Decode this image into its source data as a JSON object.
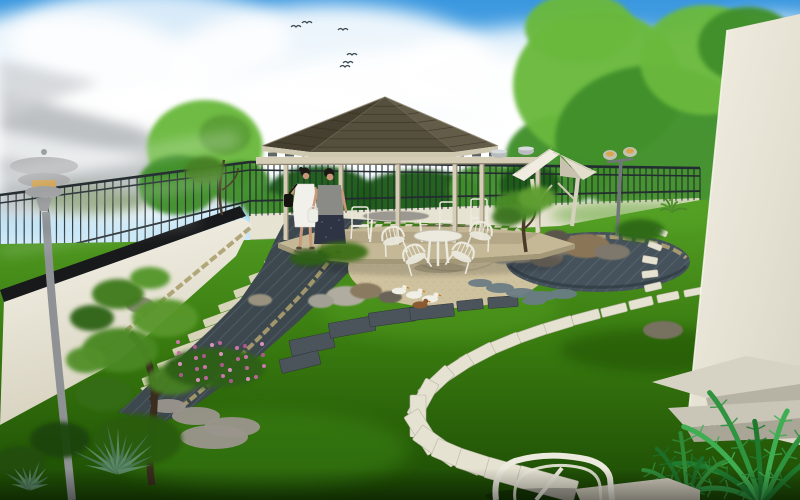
{
  "scene_type": "3d-garden-landscape-render",
  "palette": {
    "skyTop": "#3a97df",
    "skyLow": "#cfeaf8",
    "cloud": "#ffffff",
    "bird": "#3a4a55",
    "treeLight": "#6ab93c",
    "treeMid": "#3f8f2a",
    "treeDark": "#1f5c16",
    "fence": "#232c30",
    "backWall": "#e7e3d3",
    "coping": "#17191b",
    "roofLeft": "#45402f",
    "roofFront": "#554f3e",
    "roofRight": "#635c48",
    "fascia": "#cfc8b0",
    "wood": "#d5cdb5",
    "woodShade": "#9a9178",
    "floorTan": "#c4b896",
    "floorEdge": "#a39878",
    "gravel": "#cfc29e",
    "gravelEdge": "#8f8468",
    "pathDark": "#3d484e",
    "paverCream": "#ded8c2",
    "curb": "#ab9e6e",
    "stoneWhite": "#e5e2d2",
    "stoneWhiteEdge": "#b8b5a5",
    "slabDark": "#4a545a",
    "stoneBlue": "#6a7c84",
    "stoneGrey": "#9a958c",
    "skin": "#c89878",
    "hair": "#1c1814",
    "dressWhite": "#f2f0ea",
    "bagBlack": "#15130f",
    "topGrey": "#8a8a86",
    "skirtNavy": "#2e3444",
    "bagWhite": "#eeeee8",
    "furnitureWhite": "#eceade",
    "tableTop": "#9a9890",
    "duckWhite": "#f0efe6",
    "duckBrown": "#8a5a30",
    "beakOrange": "#c87820",
    "lampMetal": "#8e9294",
    "lampGlow": "#d8a64e",
    "agaveGreen": "#5e8a68",
    "agaveDark": "#497554",
    "trunkBrown": "#4a3a28",
    "steps1": "#d6d2c4",
    "steps2": "#b6b2a4",
    "steps3": "#c9c5b7",
    "steps4": "#a9a597"
  },
  "scene": {
    "clouds": [
      [
        120,
        150,
        180,
        70,
        0.95
      ],
      [
        60,
        90,
        150,
        80,
        0.9
      ],
      [
        330,
        60,
        160,
        55,
        0.9
      ],
      [
        430,
        110,
        200,
        60,
        0.95
      ],
      [
        560,
        75,
        170,
        50,
        0.85
      ],
      [
        680,
        120,
        180,
        55,
        0.9
      ],
      [
        770,
        60,
        120,
        45,
        0.8
      ],
      [
        240,
        130,
        160,
        50,
        0.95
      ],
      [
        520,
        160,
        200,
        45,
        0.9
      ],
      [
        700,
        180,
        160,
        40,
        0.85
      ],
      [
        150,
        40,
        140,
        50,
        0.8
      ]
    ],
    "birds": [
      [
        296,
        27
      ],
      [
        307,
        23
      ],
      [
        343,
        30
      ],
      [
        352,
        55
      ],
      [
        348,
        63
      ],
      [
        345,
        67
      ]
    ],
    "foliage_bg": [
      [
        205,
        148,
        58,
        48,
        "treeLight"
      ],
      [
        178,
        185,
        40,
        30,
        "treeMid"
      ],
      [
        240,
        183,
        30,
        22,
        "treeMid"
      ],
      [
        320,
        196,
        55,
        30,
        "treeDark"
      ],
      [
        420,
        198,
        65,
        28,
        "treeDark"
      ],
      [
        488,
        190,
        40,
        26,
        "treeMid"
      ],
      [
        560,
        160,
        55,
        45,
        "treeMid"
      ],
      [
        598,
        85,
        85,
        75,
        "treeLight"
      ],
      [
        655,
        140,
        100,
        75,
        "treeMid"
      ],
      [
        705,
        60,
        65,
        55,
        "treeLight"
      ],
      [
        580,
        28,
        55,
        35,
        "treeLight"
      ],
      [
        748,
        45,
        50,
        38,
        "treeMid"
      ],
      [
        530,
        185,
        30,
        20,
        "treeDark"
      ],
      [
        265,
        205,
        22,
        14,
        "treeMid"
      ]
    ],
    "fence": [
      {
        "x1": 0,
        "x2": 250,
        "t1": 195,
        "t2": 162,
        "b1": 288,
        "b2": 216,
        "sp": 8
      },
      {
        "x1": 250,
        "x2": 700,
        "t1": 162,
        "t2": 168,
        "b1": 216,
        "b2": 200,
        "sp": 6
      }
    ],
    "paver_stripes": {
      "from": [
        320,
        227
      ],
      "to": [
        152,
        388
      ],
      "count": 12,
      "w": 52,
      "h": 8,
      "rot": -20
    },
    "stones_white": [
      [
        694,
        292,
        20,
        7
      ],
      [
        668,
        297,
        22,
        8
      ],
      [
        641,
        303,
        24,
        9
      ],
      [
        614,
        310,
        26,
        9
      ],
      [
        586,
        317,
        28,
        10
      ],
      [
        558,
        325,
        30,
        11
      ],
      [
        530,
        334,
        32,
        11
      ],
      [
        503,
        344,
        34,
        12
      ],
      [
        477,
        356,
        36,
        13
      ],
      [
        455,
        369,
        37,
        13
      ],
      [
        436,
        383,
        38,
        14
      ],
      [
        423,
        399,
        40,
        15
      ],
      [
        418,
        416,
        42,
        16
      ],
      [
        423,
        432,
        45,
        17
      ],
      [
        437,
        446,
        48,
        18
      ],
      [
        458,
        457,
        51,
        19
      ],
      [
        484,
        466,
        54,
        20
      ],
      [
        514,
        475,
        57,
        21
      ],
      [
        547,
        484,
        60,
        22
      ]
    ],
    "stones_right": [
      [
        661,
        232,
        6,
        13
      ],
      [
        655,
        246,
        6,
        14
      ],
      [
        650,
        260,
        7,
        15
      ],
      [
        650,
        274,
        7,
        16
      ],
      [
        653,
        287,
        7,
        17
      ]
    ],
    "slabs_dark": [
      [
        312,
        344,
        44,
        16,
        -12
      ],
      [
        352,
        327,
        46,
        15,
        -10
      ],
      [
        392,
        317,
        46,
        14,
        -8
      ],
      [
        432,
        312,
        44,
        13,
        -6
      ],
      [
        300,
        362,
        40,
        14,
        -14
      ],
      [
        470,
        305,
        26,
        10,
        -6
      ],
      [
        503,
        302,
        30,
        11,
        -4
      ]
    ],
    "stones_round": [
      [
        500,
        288,
        14,
        5,
        "stoneBlue"
      ],
      [
        521,
        293,
        15,
        5,
        "stoneBlue"
      ],
      [
        542,
        296,
        15,
        5,
        "stoneBlue"
      ],
      [
        563,
        294,
        14,
        5,
        "stoneBlue"
      ],
      [
        480,
        283,
        12,
        4,
        "stoneBlue"
      ],
      [
        534,
        301,
        12,
        4,
        "stoneBlue"
      ],
      [
        196,
        416,
        24,
        9,
        "stoneGrey"
      ],
      [
        232,
        427,
        28,
        10,
        "stoneGrey"
      ],
      [
        168,
        406,
        18,
        7,
        "stoneGrey"
      ],
      [
        214,
        437,
        34,
        12,
        "stoneGrey"
      ]
    ],
    "rocks": [
      [
        346,
        296,
        20,
        10,
        "#b0aca0"
      ],
      [
        321,
        301,
        13,
        7,
        "#a2a096"
      ],
      [
        366,
        291,
        16,
        8,
        "#8a7a60"
      ],
      [
        390,
        297,
        12,
        6,
        "#6a6458"
      ],
      [
        520,
        252,
        22,
        11,
        "#8a8478"
      ],
      [
        546,
        258,
        17,
        9,
        "#6f695e"
      ],
      [
        503,
        257,
        13,
        7,
        "#9a948a"
      ],
      [
        562,
        247,
        15,
        8,
        "#7a746a"
      ],
      [
        586,
        246,
        24,
        12,
        "#8a7456"
      ],
      [
        556,
        237,
        13,
        7,
        "#5a544c"
      ],
      [
        612,
        252,
        18,
        8,
        "#7e786c"
      ],
      [
        140,
        305,
        14,
        8,
        "#8e8a7e"
      ],
      [
        260,
        300,
        12,
        6,
        "#98927f"
      ],
      [
        663,
        330,
        20,
        9,
        "#77715f"
      ]
    ],
    "foliage_fg": [
      [
        120,
        350,
        38,
        22,
        "#4a8824"
      ],
      [
        165,
        318,
        33,
        19,
        "#58962c"
      ],
      [
        104,
        394,
        28,
        17,
        "#356c16"
      ],
      [
        172,
        380,
        26,
        15,
        "#477f20"
      ],
      [
        138,
        440,
        44,
        26,
        "#2c5c10"
      ],
      [
        86,
        360,
        20,
        13,
        "#52902a"
      ],
      [
        118,
        294,
        26,
        15,
        "#3f7a1e"
      ],
      [
        92,
        318,
        22,
        13,
        "#2f6414"
      ],
      [
        150,
        278,
        20,
        11,
        "#54962c"
      ],
      [
        215,
        368,
        50,
        20,
        "#2f6012"
      ],
      [
        518,
        206,
        24,
        15,
        "#4a8a28"
      ],
      [
        537,
        198,
        19,
        12,
        "#5f9e32"
      ],
      [
        507,
        217,
        15,
        9,
        "#3c7520"
      ],
      [
        640,
        230,
        24,
        11,
        "#2f6a14"
      ],
      [
        60,
        440,
        30,
        18,
        "#1c4408"
      ],
      [
        20,
        462,
        26,
        16,
        "#224e0a"
      ],
      [
        342,
        252,
        26,
        10,
        "#3c7018"
      ],
      [
        310,
        258,
        20,
        8,
        "#2f6012"
      ],
      [
        225,
        135,
        26,
        20,
        "#5a9e36"
      ],
      [
        205,
        170,
        20,
        14,
        "#447f24"
      ]
    ],
    "flowers": {
      "x": 178,
      "y": 342,
      "dx": 13,
      "dy": 11,
      "count": 28,
      "colors": [
        "#d878b8",
        "#b85898",
        "#e898cc",
        "#c867a6"
      ]
    },
    "agaves": [
      {
        "x": 118,
        "y": 472,
        "n": 13,
        "len": 52
      },
      {
        "x": 30,
        "y": 488,
        "n": 9,
        "len": 30
      }
    ],
    "palms": [
      {
        "x": 762,
        "y": 505,
        "n": 8,
        "a0": -175,
        "a1": -35,
        "len": 120,
        "arc": 26,
        "w": 5,
        "cols": [
          "#2f9440",
          "#1f7a2e",
          "#3fae52"
        ]
      },
      {
        "x": 688,
        "y": 505,
        "n": 6,
        "a0": -165,
        "a1": -50,
        "len": 70,
        "arc": 16,
        "w": 4,
        "cols": [
          "#1d6e28",
          "#2f8a38"
        ]
      },
      {
        "x": 672,
        "y": 212,
        "n": 7,
        "a0": -170,
        "a1": -10,
        "len": 16,
        "arc": 4,
        "w": 2,
        "cols": [
          "#4a8a2a",
          "#57982f"
        ]
      }
    ],
    "ducks": [
      [
        399,
        291,
        0.9,
        "duckWhite"
      ],
      [
        414,
        295,
        1,
        "duckWhite"
      ],
      [
        430,
        299,
        1,
        "duckWhite"
      ],
      [
        420,
        305,
        0.95,
        "duckBrown"
      ]
    ],
    "gazebo": {
      "posts": [
        [
          286,
          240
        ],
        [
          341,
          243
        ],
        [
          398,
          245
        ],
        [
          455,
          243
        ],
        [
          482,
          239
        ],
        [
          538,
          233
        ]
      ],
      "chairs": [
        [
          330,
          204
        ],
        [
          360,
          207
        ],
        [
          448,
          202
        ],
        [
          479,
          199
        ]
      ],
      "clerestory": {
        "x1": 268,
        "x2": 494,
        "step": 17,
        "w": 9,
        "y": 152.5,
        "h": 4
      }
    },
    "patio_chairs": [
      [
        393,
        237,
        -12
      ],
      [
        481,
        232,
        12
      ],
      [
        463,
        253,
        25
      ],
      [
        414,
        255,
        -25
      ]
    ]
  }
}
